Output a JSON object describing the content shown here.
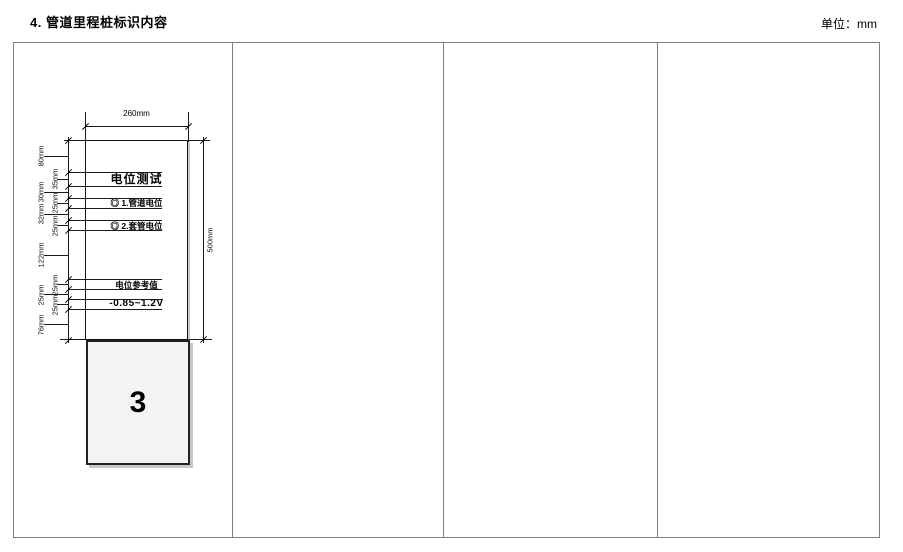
{
  "page": {
    "title": "4. 管道里程桩标识内容",
    "unit_label": "单位：mm"
  },
  "table": {
    "columns": 4,
    "border_color": "#808080"
  },
  "drawing": {
    "top_dim": "260mm",
    "right_dim": "500mm",
    "left_dims": [
      {
        "mm": 80,
        "label": "80mm"
      },
      {
        "mm": 35,
        "label": "35mm"
      },
      {
        "mm": 30,
        "label": "30mm"
      },
      {
        "mm": 25,
        "label": "25mm"
      },
      {
        "mm": 32,
        "label": "32mm"
      },
      {
        "mm": 25,
        "label": "25mm"
      },
      {
        "mm": 122,
        "label": "122mm"
      },
      {
        "mm": 25,
        "label": "25mm"
      },
      {
        "mm": 25,
        "label": "25mm"
      },
      {
        "mm": 25,
        "label": "25mm"
      },
      {
        "mm": 76,
        "label": "76mm"
      }
    ],
    "sign": {
      "title": "电位测试",
      "line1": "◎ 1.管道电位",
      "line2": "◎ 2.套管电位",
      "line3": "电位参考值",
      "line4": "-0.85~1.2V"
    },
    "pile_number": "3",
    "line_color": "#1a1a1a",
    "pile_fill": "#f3f3f3"
  }
}
